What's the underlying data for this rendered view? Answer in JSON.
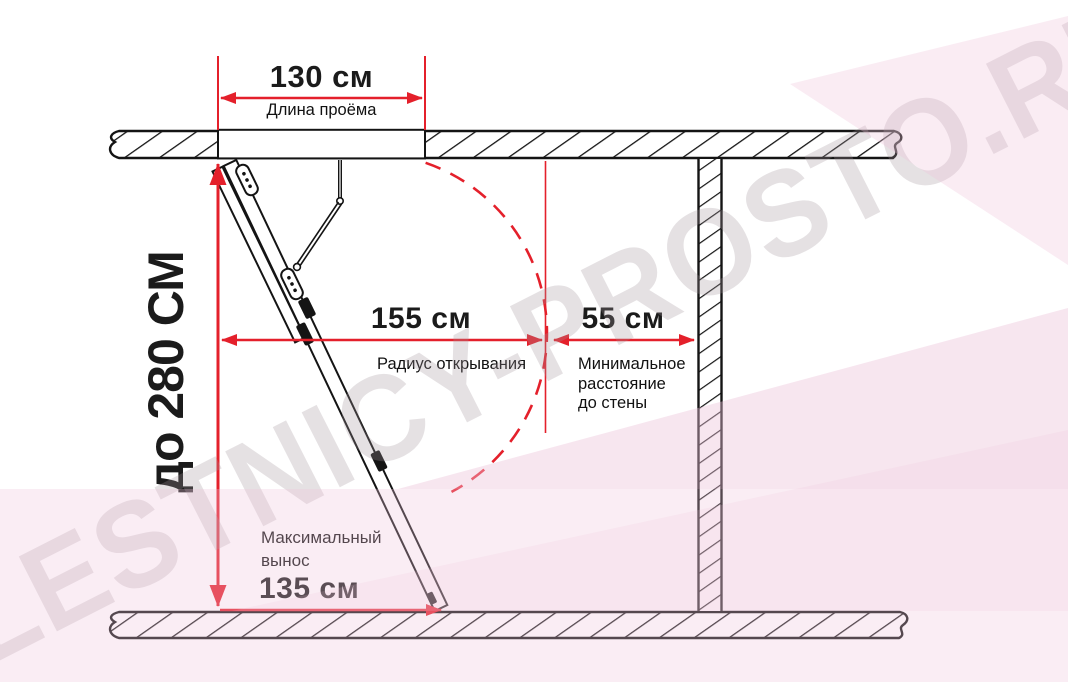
{
  "watermark": {
    "text": "LESTNICY-PROSTO.RU"
  },
  "colors": {
    "dimension_red": "#e4202b",
    "line_black": "#141414",
    "watermark_pink": "#f3d6e7",
    "watermark_gray": "#a3969d"
  },
  "diagram": {
    "dimensions": {
      "opening_length": {
        "value": "130 см",
        "label": "Длина проёма"
      },
      "ceiling_height": {
        "value": "до 280 СМ"
      },
      "opening_radius": {
        "value": "155 см",
        "label": "Радиус открывания"
      },
      "wall_distance": {
        "value": "55 см",
        "label_line1": "Минимальное",
        "label_line2": "расстояние",
        "label_line3": "до стены"
      },
      "max_extension": {
        "value": "135 см",
        "label_line1": "Максимальный",
        "label_line2": "вынос"
      }
    }
  }
}
